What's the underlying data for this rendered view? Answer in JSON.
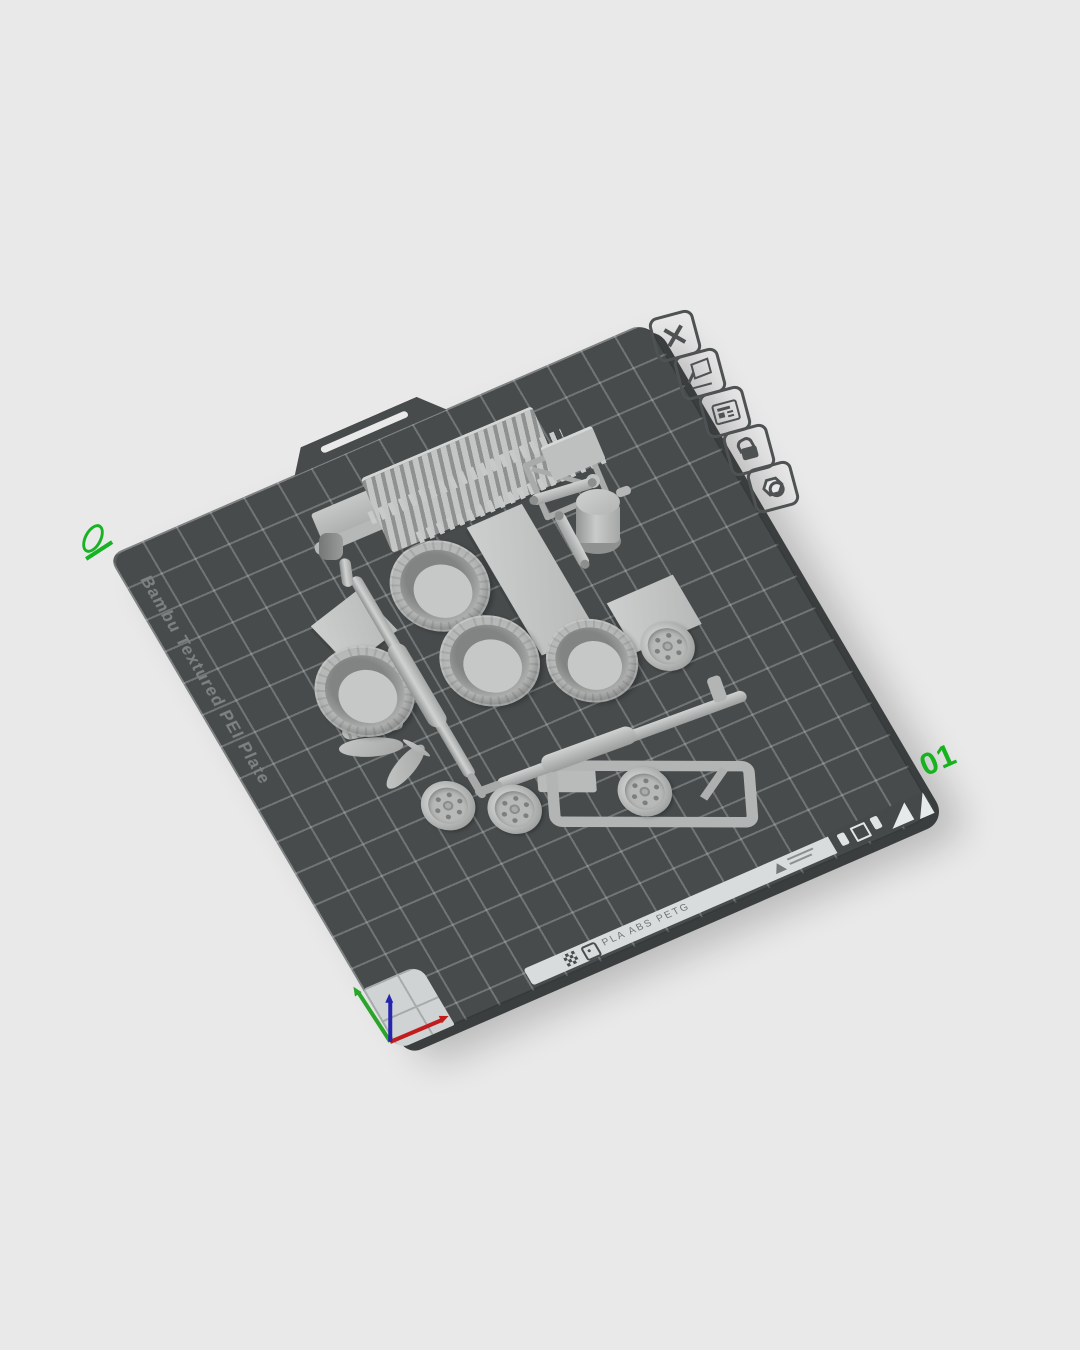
{
  "plate": {
    "name": "Bambu Textured PEI Plate",
    "number": "01",
    "materials": "PLA ABS PETG",
    "surface_color": "#474b4c",
    "grid_line_color": "rgba(228,233,233,0.26)",
    "apron_color": "#d9dcdc",
    "accent_green": "#16b31e"
  },
  "plate_toolbar": {
    "items": [
      {
        "name": "delete-plate",
        "icon": "close-x-icon"
      },
      {
        "name": "edit-plate",
        "icon": "plate-pencil-icon"
      },
      {
        "name": "plate-label",
        "icon": "label-list-icon"
      },
      {
        "name": "lock-plate",
        "icon": "unlocked-padlock-icon"
      },
      {
        "name": "plate-settings",
        "icon": "hex-nut-icon"
      }
    ]
  },
  "models": [
    "radiator-grille-assembly",
    "cab-roof-panel",
    "window-frame",
    "fuel-tank",
    "suspension-arm",
    "suspension-arm",
    "flat-panel-large",
    "flat-panel-small",
    "flat-panel-small",
    "tire",
    "tire",
    "tire",
    "tire",
    "wheel-rim",
    "wheel-rim",
    "wheel-rim",
    "wheel-rim",
    "exhaust-pipe",
    "exhaust-pipe",
    "chassis-frame",
    "running-board",
    "fender-leaf-set"
  ],
  "axis_gizmo": {
    "x_color": "#c21d1d",
    "y_color": "#2aa52a",
    "z_color": "#2525ad"
  },
  "background_color": "#e9e9e9"
}
